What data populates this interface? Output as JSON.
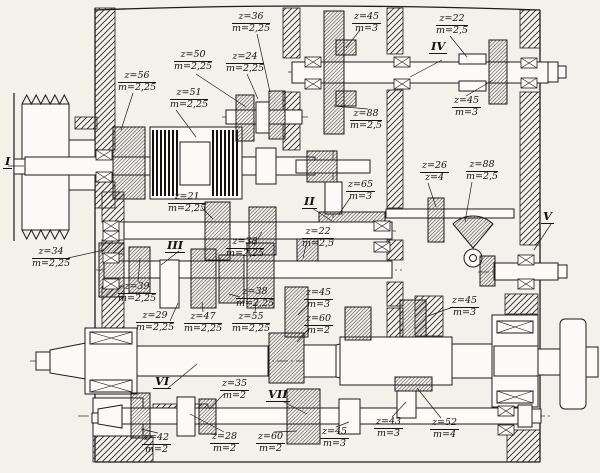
{
  "drawing": {
    "kind": "Gearbox sectional drawing (machine-tool headstock)",
    "ink_color": "#1c1c1c",
    "paper_color": "#f3f1ea"
  },
  "shafts": [
    {
      "numeral": "I"
    },
    {
      "numeral": "II"
    },
    {
      "numeral": "III"
    },
    {
      "numeral": "IV"
    },
    {
      "numeral": "V"
    },
    {
      "numeral": "VI"
    },
    {
      "numeral": "VII"
    }
  ],
  "gear_labels": [
    {
      "teeth": "z=56",
      "module": "m=2,25"
    },
    {
      "teeth": "z=50",
      "module": "m=2,25"
    },
    {
      "teeth": "z=51",
      "module": "m=2,25"
    },
    {
      "teeth": "z=24",
      "module": "m=2,25"
    },
    {
      "teeth": "z=36",
      "module": "m=2,25"
    },
    {
      "teeth": "z=45",
      "module": "m=3"
    },
    {
      "teeth": "z=22",
      "module": "m=2,5"
    },
    {
      "teeth": "z=88",
      "module": "m=2,5"
    },
    {
      "teeth": "z=45",
      "module": "m=3"
    },
    {
      "teeth": "z=21",
      "module": "m=2,25"
    },
    {
      "teeth": "z=38",
      "module": "m=2,25"
    },
    {
      "teeth": "z=22",
      "module": "m=2,5"
    },
    {
      "teeth": "z=65",
      "module": "m=3"
    },
    {
      "teeth": "z=26",
      "module": "z=4"
    },
    {
      "teeth": "z=88",
      "module": "m=2,5"
    },
    {
      "teeth": "z=34",
      "module": "m=2,25"
    },
    {
      "teeth": "z=39",
      "module": "m=2,25"
    },
    {
      "teeth": "z=38",
      "module": "m=2,25"
    },
    {
      "teeth": "z=29",
      "module": "m=2,25"
    },
    {
      "teeth": "z=47",
      "module": "m=2,25"
    },
    {
      "teeth": "z=55",
      "module": "m=2,25"
    },
    {
      "teeth": "z=45",
      "module": "m=3"
    },
    {
      "teeth": "z=60",
      "module": "m=2"
    },
    {
      "teeth": "z=42",
      "module": "m=2"
    },
    {
      "teeth": "z=35",
      "module": "m=2"
    },
    {
      "teeth": "z=28",
      "module": "m=2"
    },
    {
      "teeth": "z=60",
      "module": "m=2"
    },
    {
      "teeth": "z=45",
      "module": "m=3"
    },
    {
      "teeth": "z=43",
      "module": "m=3"
    },
    {
      "teeth": "z=52",
      "module": "m=4"
    },
    {
      "teeth": "z=45",
      "module": "m=3"
    }
  ]
}
